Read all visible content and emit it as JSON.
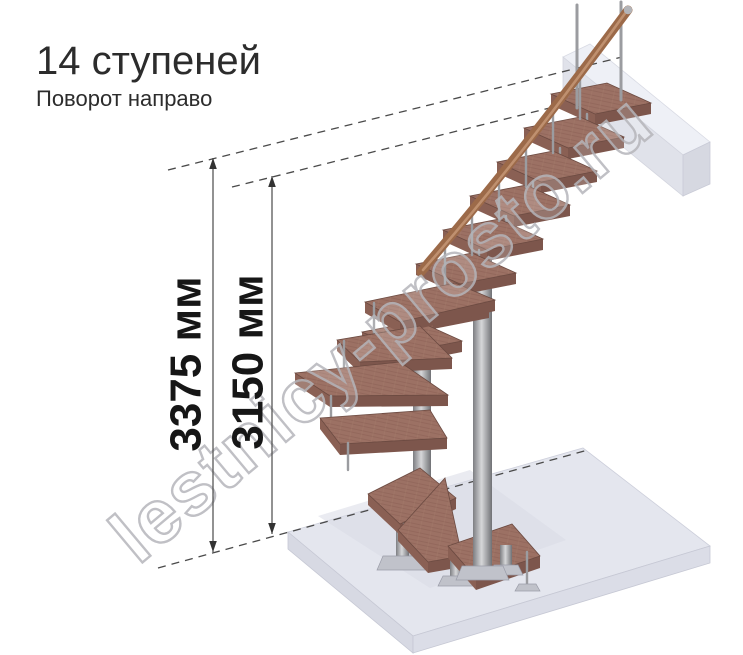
{
  "header": {
    "title": "14 ступеней",
    "subtitle": "Поворот направо"
  },
  "dimensions": {
    "overall": {
      "label": "3375 мм"
    },
    "to_platform": {
      "label": "3150 мм"
    }
  },
  "watermark": {
    "text": "lestnicy-prosto.ru"
  },
  "staircase": {
    "steps_count": 14,
    "turn_direction": "направо",
    "colors": {
      "wood": "#9c7164",
      "wood_shadow": "#7d564c",
      "handrail": "#9c6a49",
      "metal": "#9b9ca0",
      "floor_slab": "#e4e6ee",
      "upper_beam": "#edeef4",
      "dimension_lines": "#4a4a4a",
      "dimension_text": "#161616",
      "title_text": "#2c2c2c",
      "watermark_outline": "#b6b6bb"
    }
  }
}
